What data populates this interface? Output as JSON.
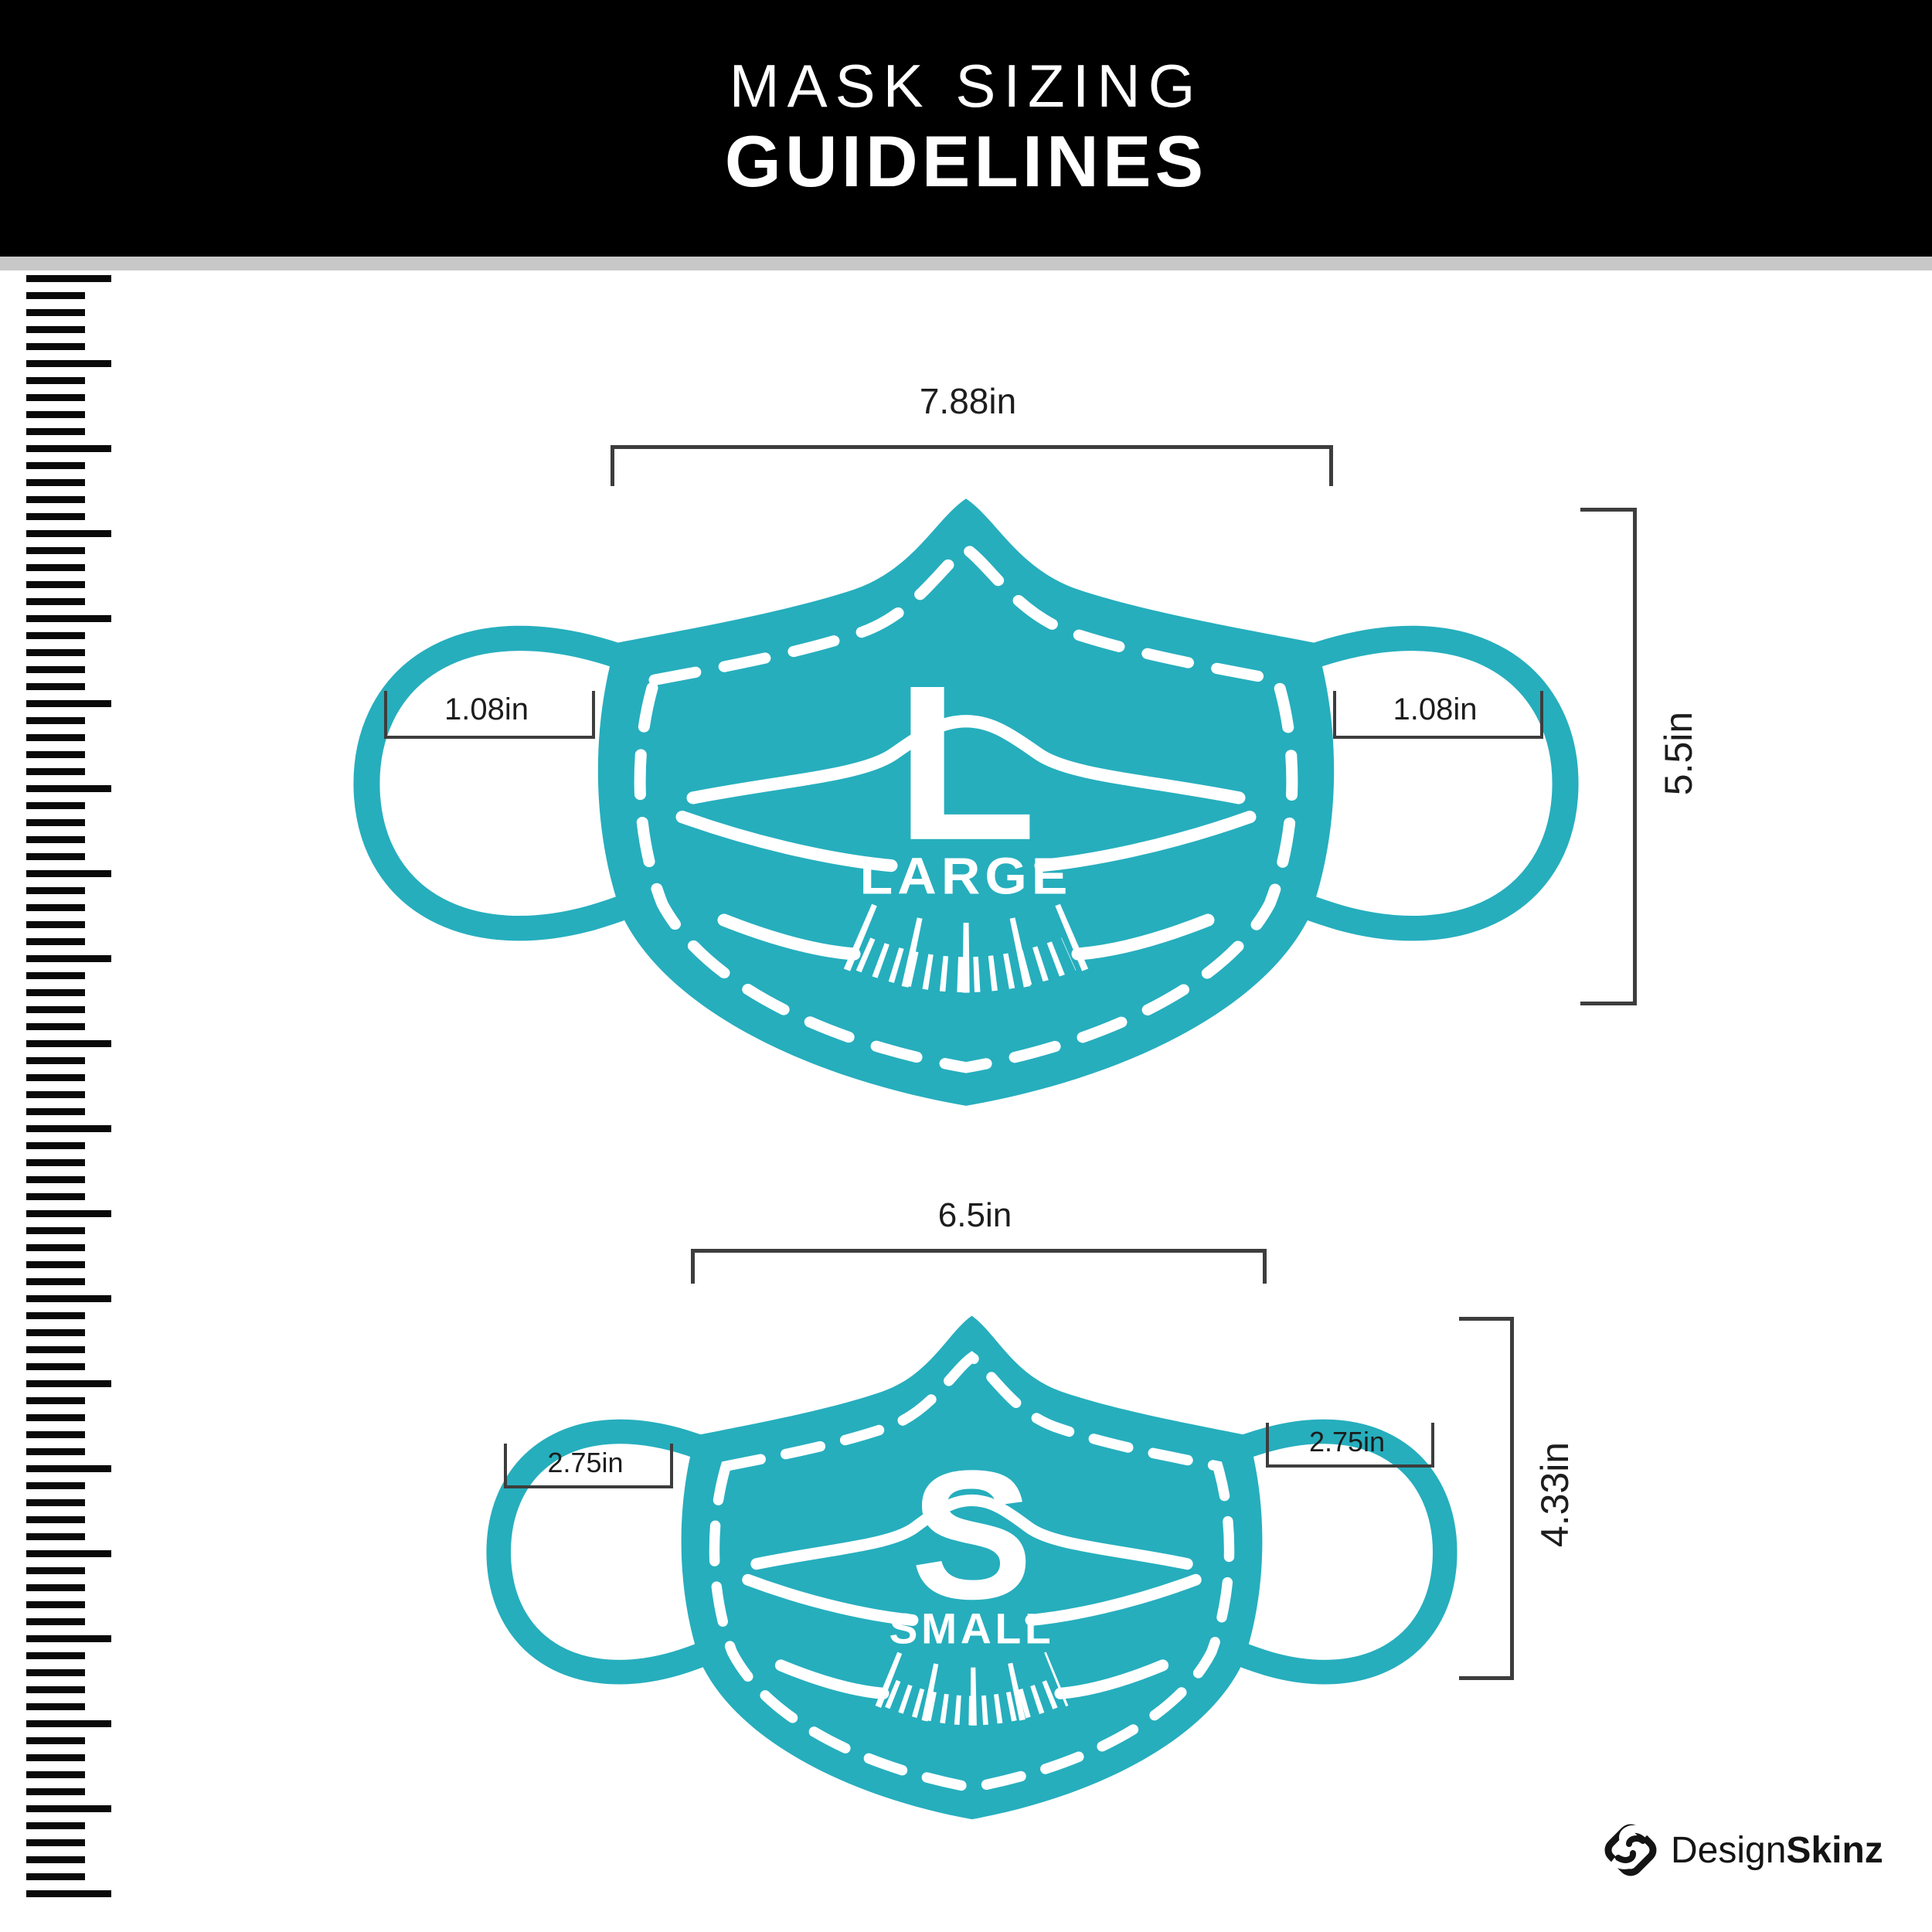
{
  "header": {
    "line1": "MASK SIZING",
    "line2": "GUIDELINES"
  },
  "masks": {
    "large": {
      "letter": "L",
      "name": "LARGE",
      "width": "7.88in",
      "height": "5.5in",
      "ear_left": "1.08in",
      "ear_right": "1.08in"
    },
    "small": {
      "letter": "S",
      "name": "SMALL",
      "width": "6.5in",
      "height": "4.33in",
      "ear_left": "2.75in",
      "ear_right": "2.75in"
    }
  },
  "brand": {
    "name_regular": "Design",
    "name_bold": "Skinz"
  },
  "colors": {
    "teal": "#26aebd",
    "header_bg": "#000000",
    "divider": "#c8c8c8",
    "dimension": "#3d3d3d",
    "ruler": "#0a0a0a",
    "text": "#1d1d1d"
  }
}
